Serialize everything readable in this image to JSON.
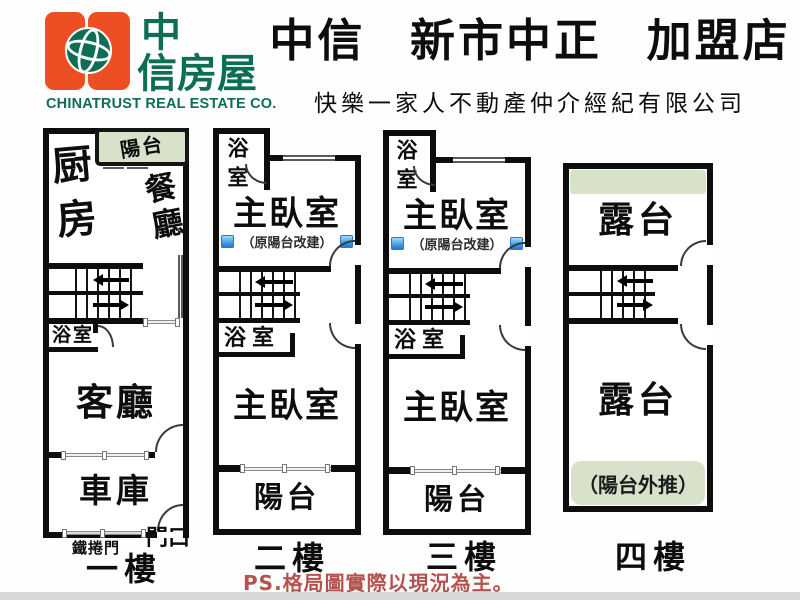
{
  "header": {
    "logo": {
      "cn_top": "中",
      "cn_bottom": "信房屋",
      "en": "CHINATRUST REAL ESTATE CO."
    },
    "title": "中信 新市中正 加盟店",
    "subtitle": "快樂一家人不動產仲介經紀有限公司"
  },
  "plans": {
    "f1": {
      "balcony": "陽台",
      "kitchen": "厨房",
      "dining": "餐廳",
      "bathroom": "浴室",
      "living": "客廳",
      "garage": "車庫",
      "roller_door": "鐵捲門",
      "entrance": "門口",
      "floor_label": "一樓"
    },
    "f2": {
      "bathroom_top": "浴室",
      "master_top": "主臥室",
      "note": "（原陽台改建）",
      "bathroom_mid": "浴室",
      "master_bottom": "主臥室",
      "balcony": "陽台",
      "floor_label": "二樓"
    },
    "f3": {
      "bathroom_top": "浴室",
      "master_top": "主臥室",
      "note": "（原陽台改建）",
      "bathroom_mid": "浴室",
      "master_bottom": "主臥室",
      "balcony": "陽台",
      "floor_label": "三樓"
    },
    "f4": {
      "terrace_top": "露台",
      "terrace_bottom": "露台",
      "note": "（陽台外推）",
      "floor_label": "四樓"
    }
  },
  "footer": {
    "disclaimer": "PS.格局圖實際以現況為主。"
  },
  "colors": {
    "brand_orange": "#ee4e23",
    "brand_green": "#0d6e55",
    "balcony_green": "#d8e1c9",
    "marker_blue": "#2a78c8",
    "disclaimer_red": "#b5524e"
  }
}
